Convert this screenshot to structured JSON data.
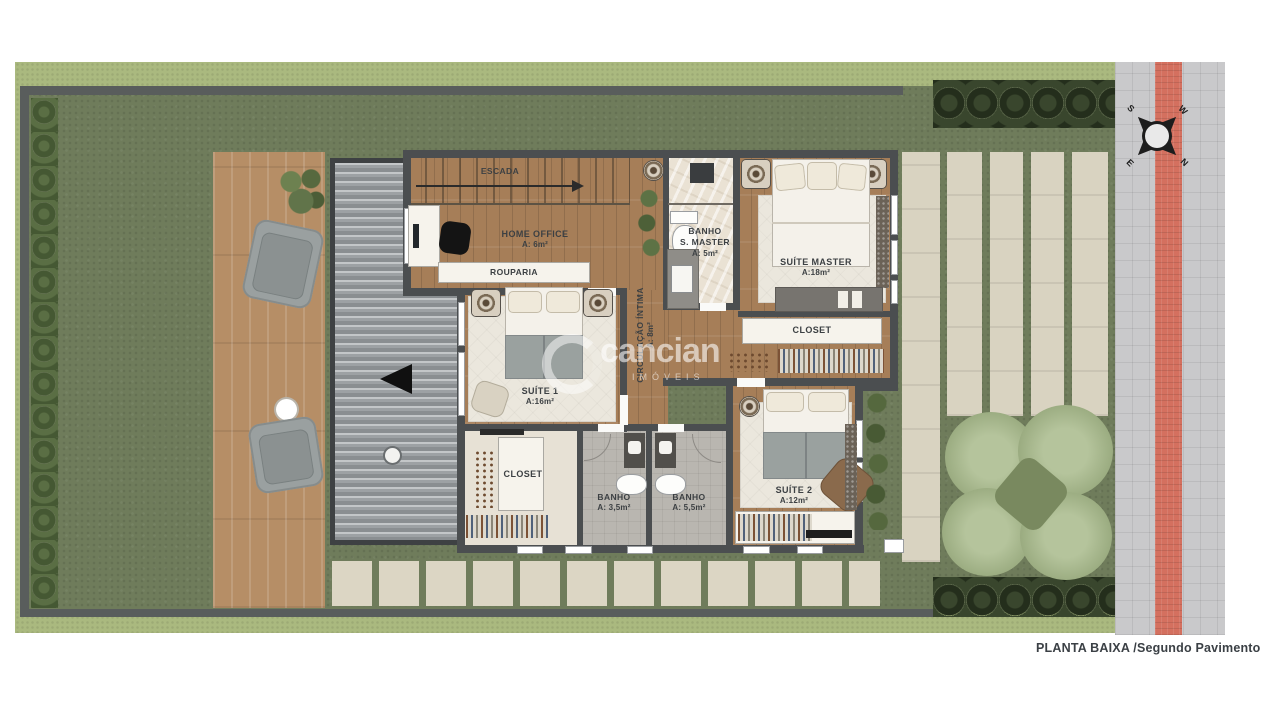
{
  "page": {
    "caption": "PLANTA BAIXA /Segundo Pavimento"
  },
  "watermark": {
    "brand": "cancian",
    "tagline": "IMÓVEIS"
  },
  "compass": {
    "n": "N",
    "s": "S",
    "e": "E",
    "w": "W"
  },
  "rooms": {
    "escada": {
      "label": "ESCADA"
    },
    "home_office": {
      "label": "HOME OFFICE",
      "area": "A: 6m²"
    },
    "rouparia": {
      "label": "ROUPARIA"
    },
    "banho_master": {
      "label": "BANHO",
      "label2": "S. MASTER",
      "area": "A: 5m²"
    },
    "suite_master": {
      "label": "SUÍTE MASTER",
      "area": "A:18m²"
    },
    "closet_master": {
      "label": "CLOSET"
    },
    "circulacao": {
      "label": "CIRCULAÇÃO ÍNTIMA",
      "area": "A: 8m²"
    },
    "suite_1": {
      "label": "SUÍTE 1",
      "area": "A:16m²"
    },
    "closet_1": {
      "label": "CLOSET"
    },
    "banho_1": {
      "label": "BANHO",
      "area": "A: 3,5m²"
    },
    "banho_2": {
      "label": "BANHO",
      "area": "A: 5,5m²"
    },
    "suite_2": {
      "label": "SUÍTE 2",
      "area": "A:12m²"
    }
  },
  "colors": {
    "lawn": "#6f7c5b",
    "hedge_light": "#aab97f",
    "wall": "#4b4e50",
    "wood_floor": "#a67e58",
    "deck": "#b68e66",
    "roof": "#9da1a4",
    "marble": "#eae2d4",
    "rug": "#ebe7dd",
    "paver": "#d9d3c1",
    "sidewalk": "#c9c9cb",
    "tactile_red": "#d4705f",
    "tree_dark": "#2e3a28",
    "tree_light": "#9dae83"
  }
}
